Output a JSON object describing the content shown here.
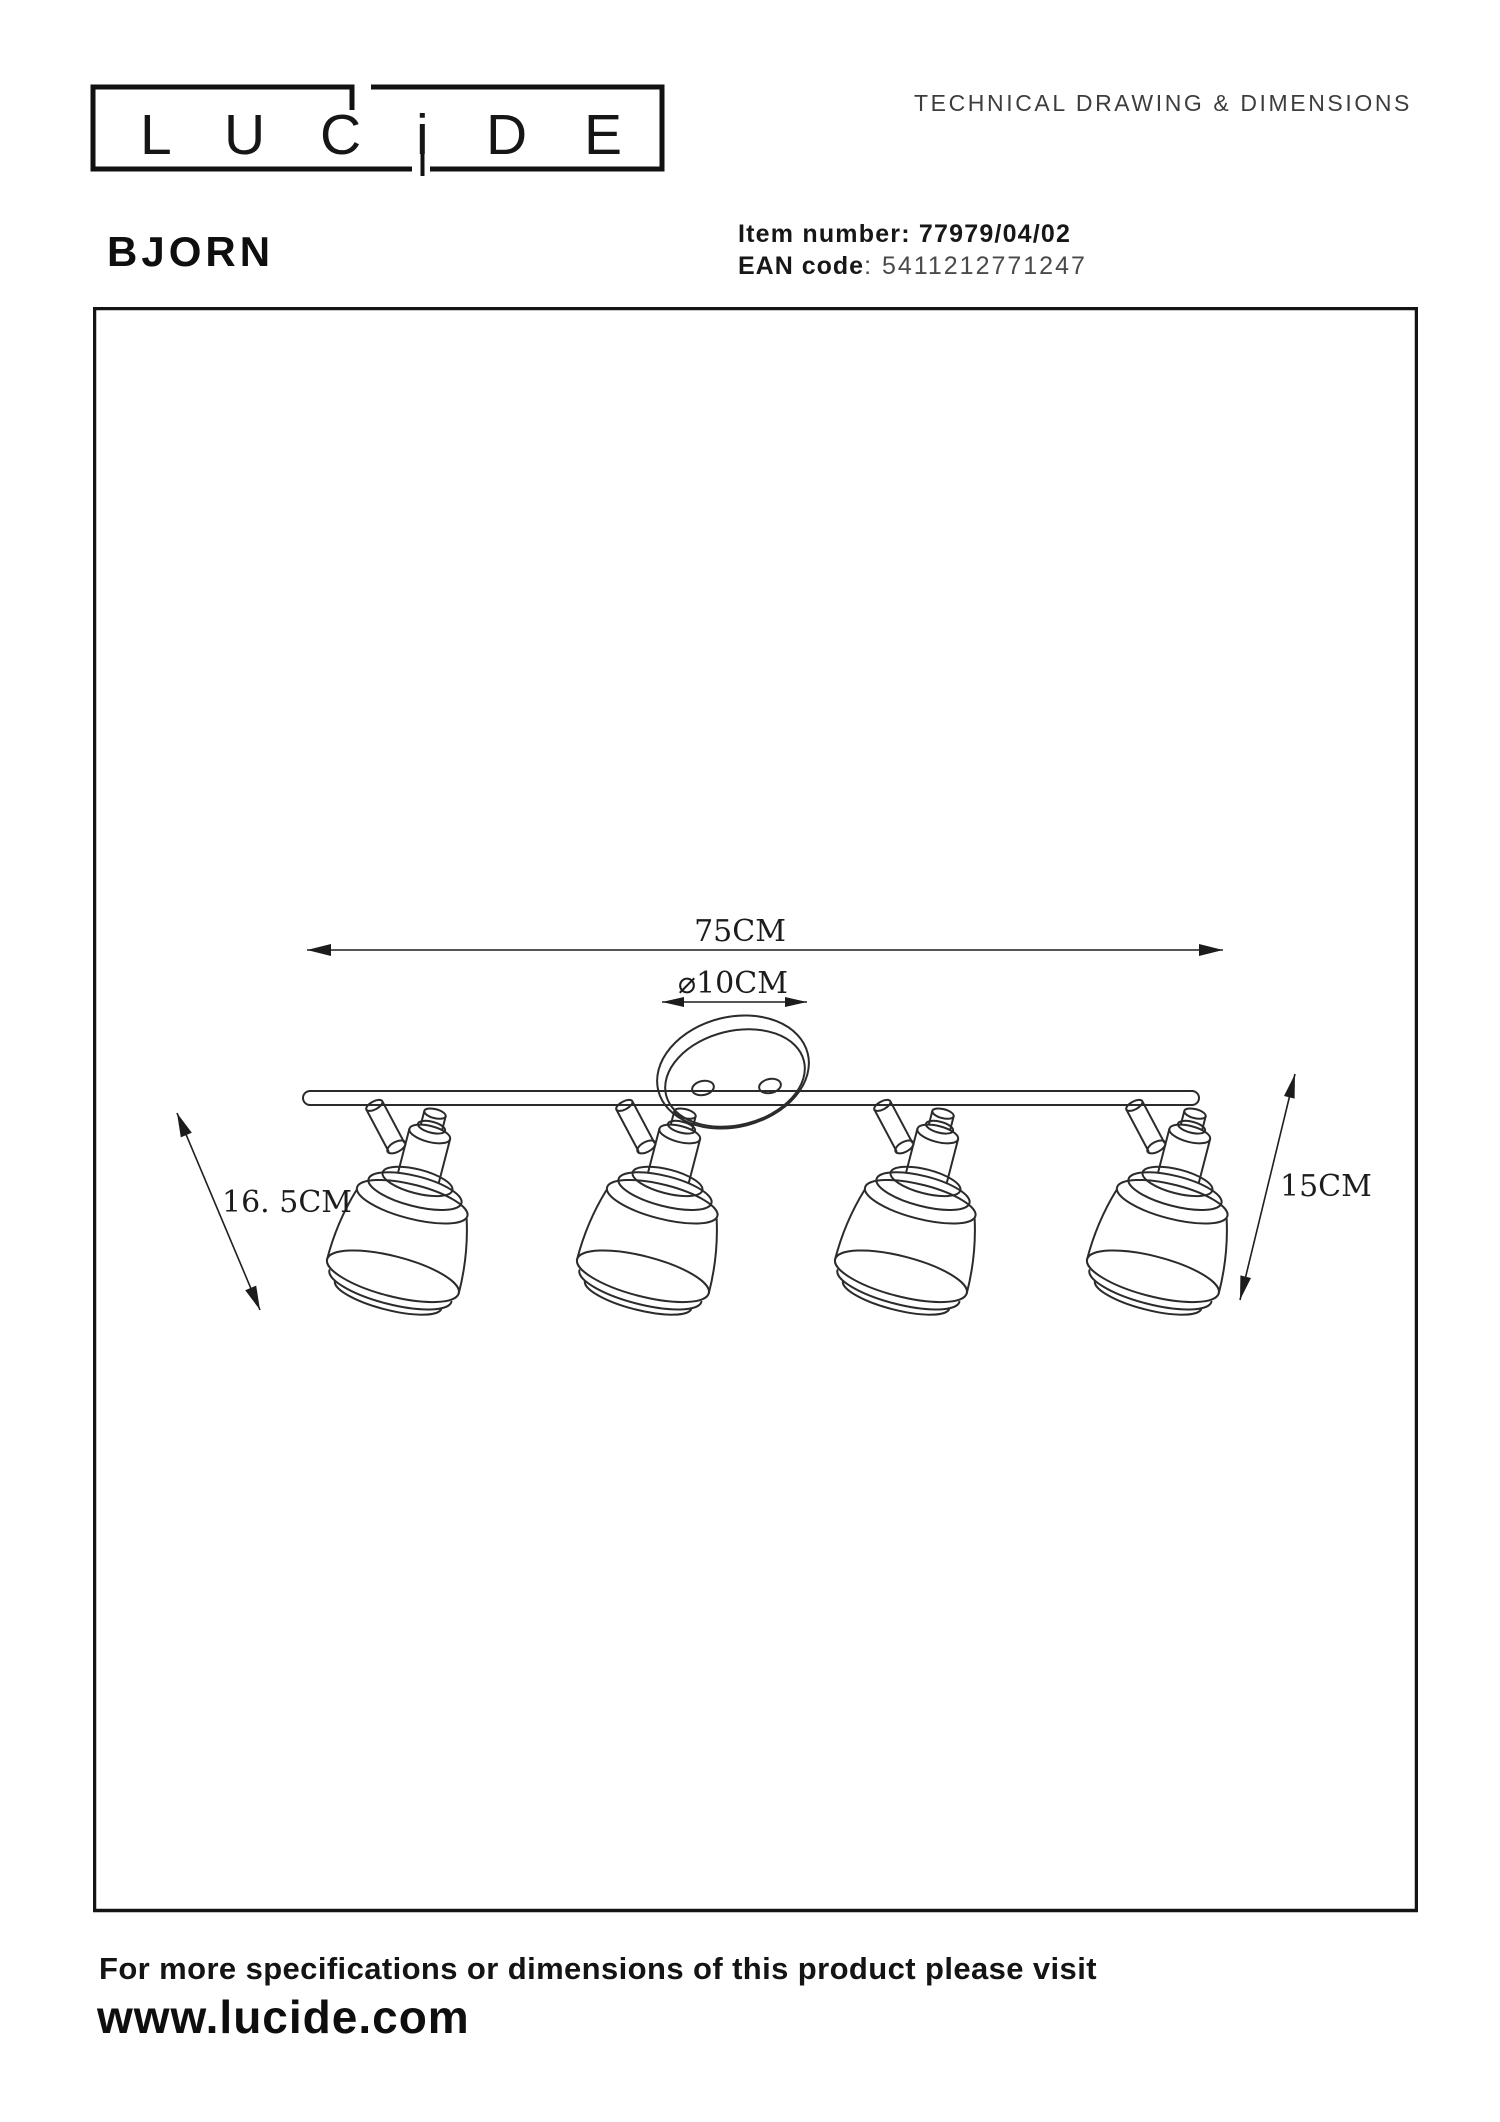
{
  "header": {
    "logo": {
      "brand": "LUCIDE",
      "letters": [
        "L",
        "U",
        "C",
        "i",
        "D",
        "E"
      ]
    },
    "doc_type": "TECHNICAL DRAWING & DIMENSIONS"
  },
  "product": {
    "name": "BJORN",
    "item_label": "Item number:",
    "item_value": "77979/04/02",
    "ean_label": "EAN code",
    "ean_separator": ": ",
    "ean_value": "5411212771247"
  },
  "drawing": {
    "dimensions": {
      "bar_length": "75CM",
      "canopy_diameter_symbol": "⌀",
      "canopy_diameter": "10CM",
      "spot_height": "16. 5CM",
      "overall_height": "15CM"
    }
  },
  "footer": {
    "note": "For more specifications or dimensions of this product please visit",
    "website": "www.lucide.com"
  }
}
